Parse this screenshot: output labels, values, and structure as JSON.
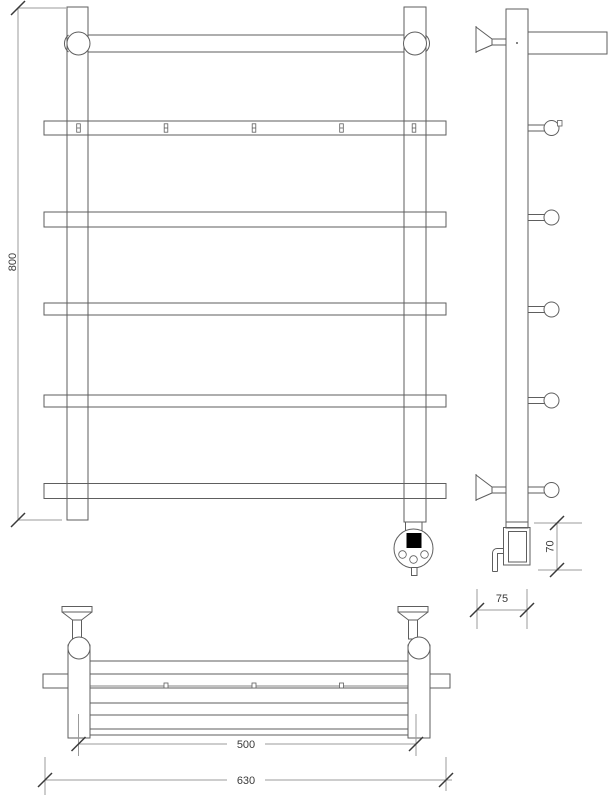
{
  "drawing": {
    "dim_height_label": "800",
    "dim_heater_label": "70",
    "dim_depth_label": "75",
    "dim_span_label": "500",
    "dim_width_label": "630"
  },
  "colors": {
    "object_line": "#5e5e5e",
    "dimension_line": "#9b9b9b",
    "tick": "#3a3a3a",
    "text": "#3a3a3a",
    "display_fill": "#000000",
    "background": "#ffffff"
  }
}
